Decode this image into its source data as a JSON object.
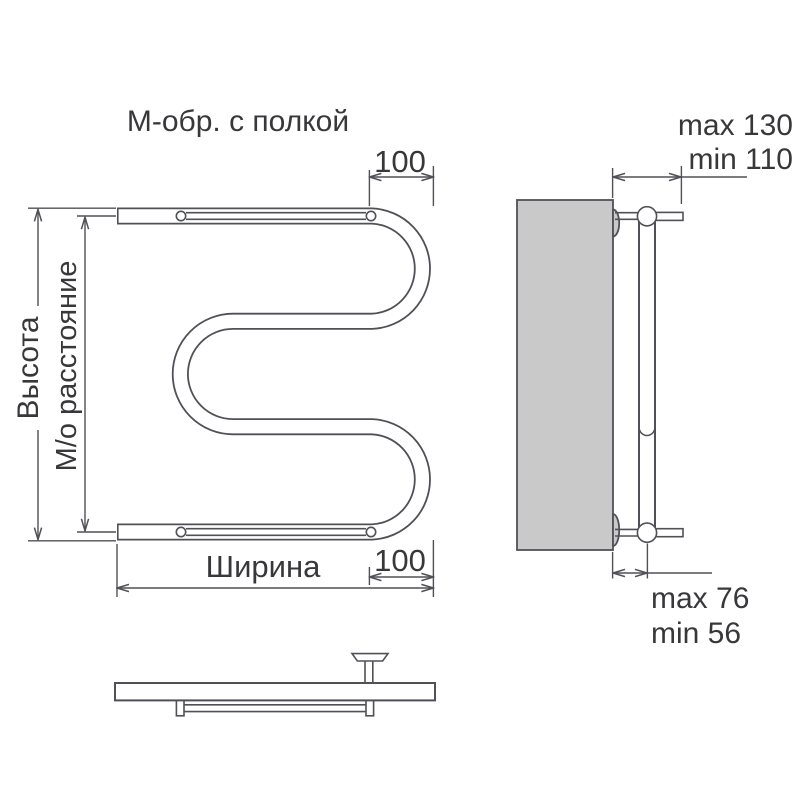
{
  "colors": {
    "line": "#505157",
    "text": "#38383b",
    "panel": "#c9c9c9",
    "background": "#ffffff"
  },
  "title": "М-обр. с полкой",
  "front_view": {
    "height_label": "Высота",
    "center_distance_label": "М/о расстояние",
    "width_label": "Ширина",
    "top_offset": "100",
    "bottom_offset": "100"
  },
  "side_view": {
    "wall_distance_top": {
      "max": "max 130",
      "min": "min 110"
    },
    "wall_distance_bottom": {
      "max": "max 76",
      "min": "min 56"
    }
  }
}
